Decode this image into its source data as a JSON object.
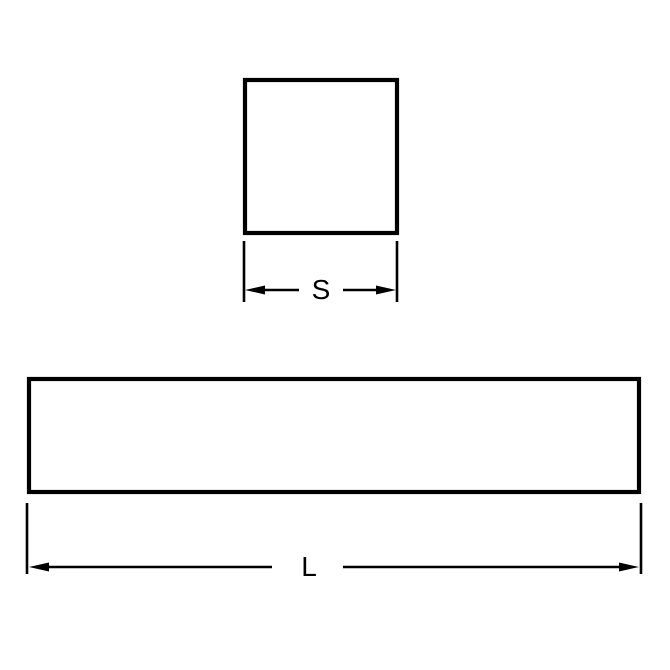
{
  "diagram": {
    "kind": "technical-dimension-drawing",
    "views": {
      "end_view": "square cross-section",
      "side_view": "long rectangular bar"
    },
    "labels": {
      "square_side": "S",
      "bar_length": "L"
    },
    "colors": {
      "line": "#000000",
      "background": "#ffffff"
    }
  }
}
